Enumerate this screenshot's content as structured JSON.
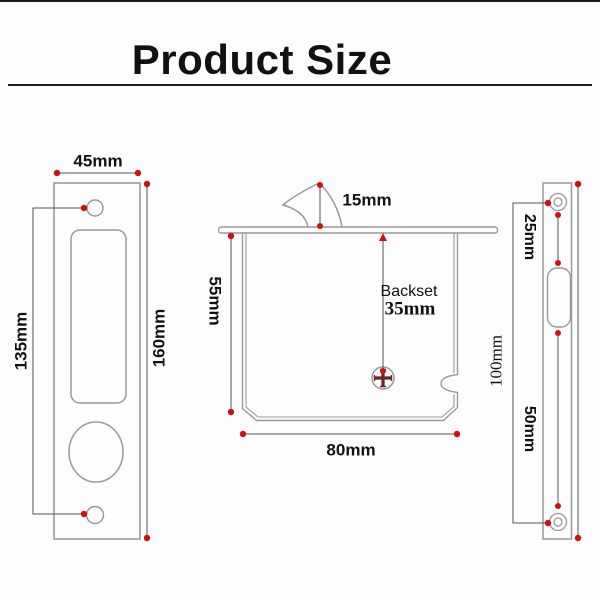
{
  "header": {
    "title": "Product Size"
  },
  "diagram": {
    "faceplate": {
      "width_label": "45mm",
      "screw_spacing_label": "135mm",
      "height_label": "160mm"
    },
    "lock_body": {
      "hook_height_label": "15mm",
      "body_height_label": "55mm",
      "backset_title": "Backset",
      "backset_value": "35mm",
      "body_width_label": "80mm"
    },
    "strike_plate": {
      "screw_to_slot_label": "25mm",
      "slot_to_screw_label": "50mm",
      "screw_spacing_label": "100mm"
    },
    "colors": {
      "outline": "#9a9a9a",
      "dimension": "#555555",
      "marker": "#cc1111",
      "screw_cross": "#6a2424"
    }
  }
}
